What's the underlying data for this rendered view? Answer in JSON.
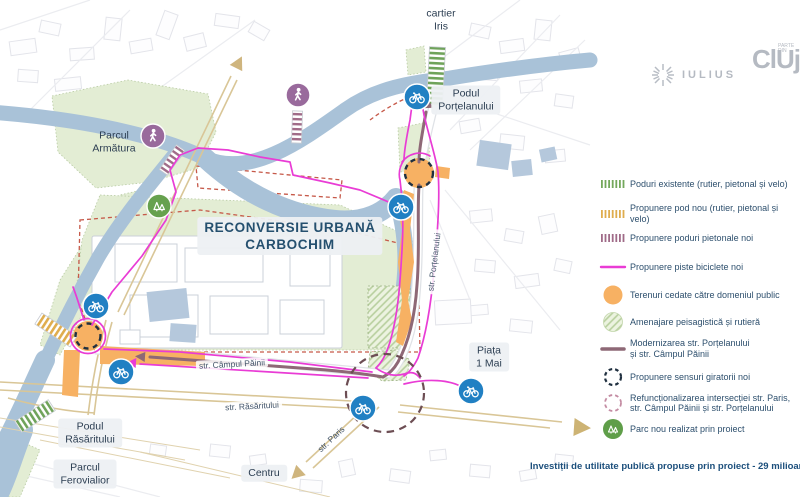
{
  "map": {
    "title": "RECONVERSIE URBANĂ\nCARBOCHIM",
    "labels": {
      "cartier_iris": "cartier\nIris",
      "podul_portelanului": "Podul\nPorțelanului",
      "parcul_armatura": "Parcul\nArmătura",
      "str_portelanului": "str. Porțelanului",
      "piata_1_mai": "Piața\n1 Mai",
      "str_campul_painii": "str. Câmpul Păinii",
      "str_rasaritului": "str. Răsăritului",
      "str_paris": "str. Paris",
      "centru": "Centru",
      "podul_rasaritului": "Podul\nRăsăritului",
      "parcul_ferovialior": "Parcul\nFerovialior"
    },
    "icons": [
      "bicycle-icon",
      "pedestrian-icon",
      "park-trees-icon"
    ],
    "colors": {
      "river": "#a9c2d8",
      "green_area": "#e3edd4",
      "orange_public": "#f7b163",
      "bike_lane_magenta": "#e93cd5",
      "modernization_mauve": "#8e6876",
      "new_roundabout_dash": "#203040",
      "intersection_dash": "#6d4e54",
      "bike_marker_blue": "#2180c3",
      "pedestrian_marker_purple": "#996a9c",
      "park_marker_green": "#5f9e49",
      "road_tan": "#d9c697",
      "site_boundary_red": "#c65949",
      "bridge_existing_green": "#6fa35a",
      "bridge_new_yellow": "#dfad4e",
      "bridge_pedestrian_mauve": "#a06b88"
    }
  },
  "legend": {
    "items": [
      {
        "label": "Poduri existente (rutier, pietonal și velo)",
        "color": "#74a85c"
      },
      {
        "label": "Propunere pod nou (rutier, pietonal și velo)",
        "color": "#dfad4e"
      },
      {
        "label": "Propunere poduri pietonale noi",
        "color": "#a06b88"
      },
      {
        "label": "Propunere piste biciclete noi",
        "color": "#e93cd5"
      },
      {
        "label": "Terenuri cedate către domeniul public",
        "color": "#f7b163"
      },
      {
        "label": "Amenajare peisagistică și rutieră",
        "color": "#cfe0bc"
      },
      {
        "label": "Modernizarea str. Porțelanului\nși str. Câmpul Păinii",
        "color": "#8e6876"
      },
      {
        "label": "Propunere sensuri giratorii noi",
        "color": "#203040"
      },
      {
        "label": "Refuncționalizarea intersecției str. Paris,\nstr. Câmpul Păinii și str. Porțelanului",
        "color": "#c48ca3"
      },
      {
        "label": "Parc nou realizat prin proiect",
        "color": "#5f9e49"
      }
    ]
  },
  "logos": {
    "iulius_text": "IULIUS",
    "cluj_text": "ClUj",
    "cluj_small": "PARTE\nDIN"
  },
  "footer": {
    "investment_note": "Investiții de utilitate publică propuse prin proiect - 29 milioane de euro"
  }
}
